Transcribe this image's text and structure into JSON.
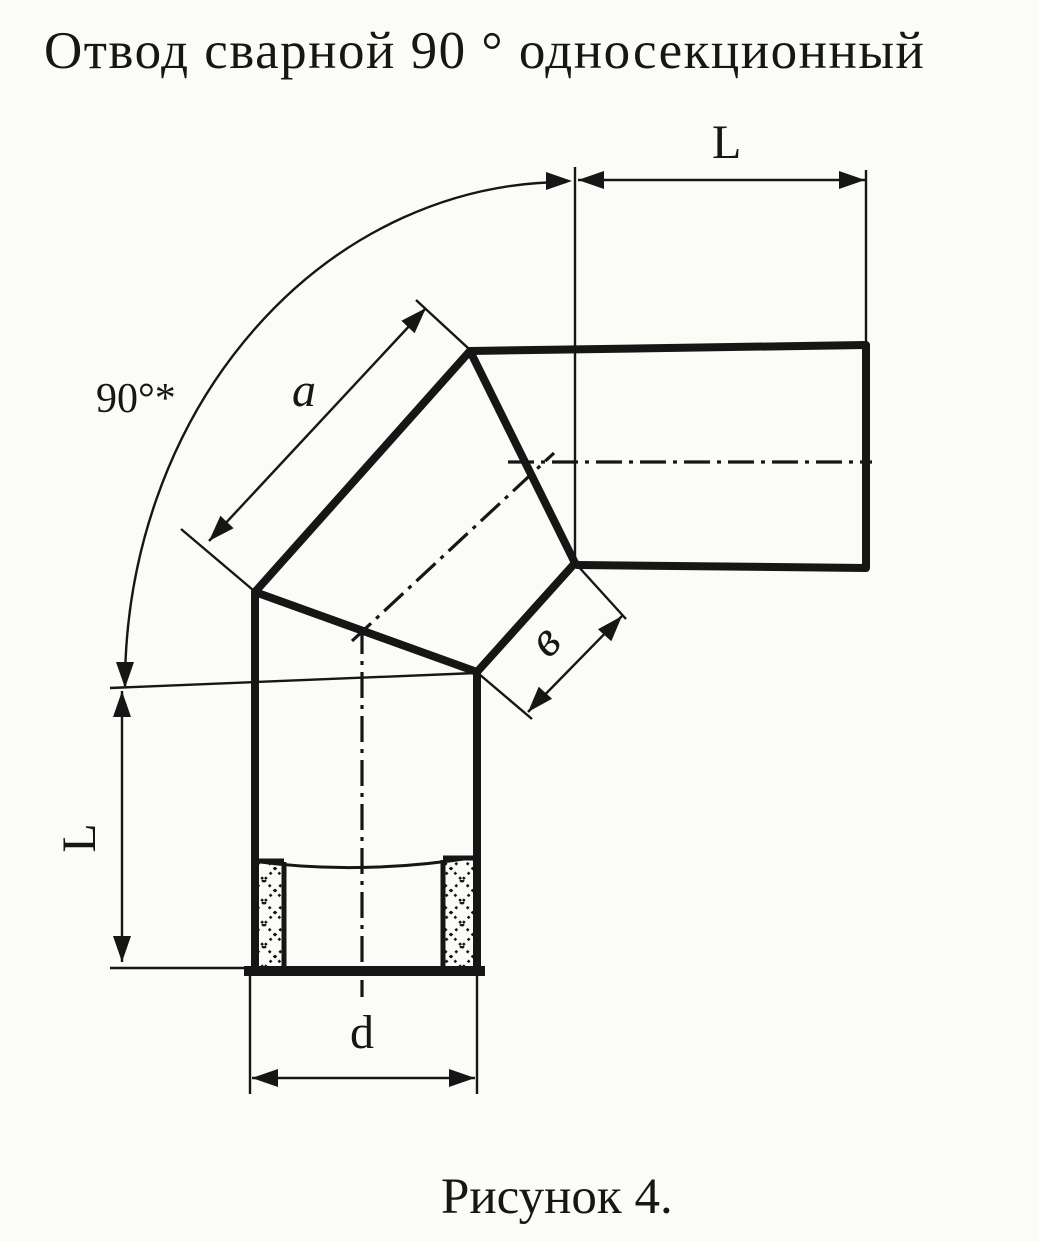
{
  "title": "Отвод сварной 90 ° односекционный",
  "caption": "Рисунок 4.",
  "dimensions": {
    "horizontal_length_label": "L",
    "vertical_length_label": "L",
    "section_side_label": "a",
    "miter_width_label": "в",
    "diameter_label": "d",
    "angle_label": "90°*"
  },
  "colors": {
    "ink": "#161616",
    "paper": "#fbfbf8"
  }
}
